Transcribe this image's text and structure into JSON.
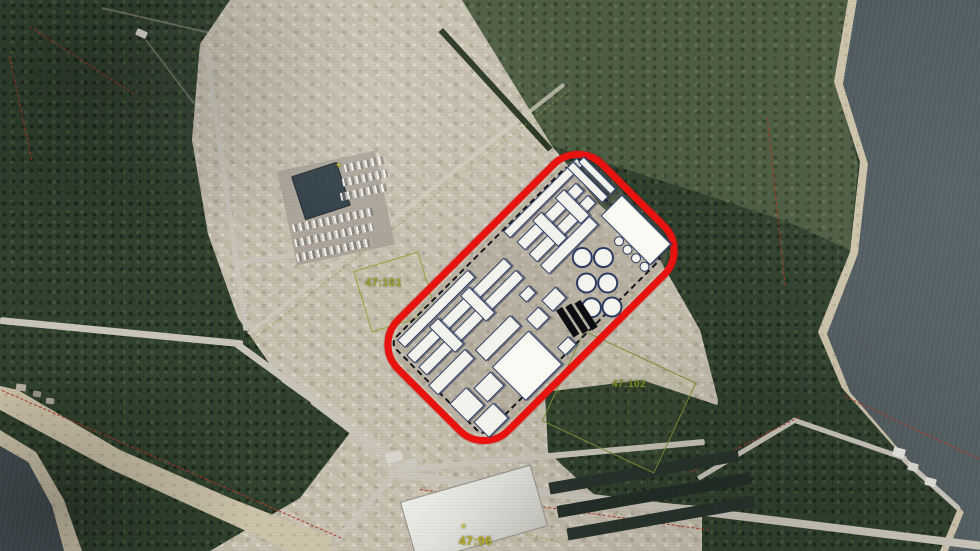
{
  "map": {
    "colors": {
      "site_outline_red": "#e8120f",
      "building_fill": "#f2f3ec",
      "building_stroke": "#2b3a63",
      "cadastral_red": "#b23726",
      "parcel_green": "#93a23a",
      "label_yellow": "#b6a81f",
      "water": "#46525a",
      "forest": "#30412e",
      "cleared_ground": "#c6bfae"
    },
    "terrain": [
      {
        "name": "forest-base",
        "tex": "forest"
      },
      {
        "name": "field-top",
        "tex": "field",
        "points": "462,0 848,0 836,80 858,165 850,250 788,222 700,193 552,146"
      },
      {
        "name": "cleared-main",
        "tex": "cleared",
        "points": "230,0 462,0 552,146 600,205 660,260 700,330 718,400 712,448 640,452 520,464 430,470 352,432 282,382 238,318 208,234 192,140 200,44"
      },
      {
        "name": "cleared-bottom",
        "tex": "cleared",
        "points": "352,430 480,462 640,430 702,452 702,551 210,551 300,498"
      },
      {
        "name": "shore-sand-strip",
        "tex": "sand",
        "points": "0,386 18,390 120,450 230,498 332,538 332,551 290,551 108,468 0,410"
      },
      {
        "name": "forest-patch-bottom",
        "tex": "forest",
        "points": "545,392 642,380 762,420 782,470 700,506 598,498 548,452"
      },
      {
        "name": "scrub-patch",
        "tex": "forest",
        "opacity": 0.55,
        "points": "788,470 868,458 932,490 858,520 788,506"
      },
      {
        "name": "beach-right",
        "tex": "sand",
        "points": "848,0 980,0 980,551 940,551 958,508 902,456 842,388 818,332 850,252 860,162 834,82"
      },
      {
        "name": "lake-right",
        "tex": "water",
        "points": "857,0 980,0 980,551 948,551 964,512 910,462 850,392 827,334 858,254 868,164 843,84"
      },
      {
        "name": "beach-bottom-left",
        "tex": "sand",
        "points": "0,430 36,452 64,500 82,551 0,551"
      },
      {
        "name": "water-bottom-left",
        "tex": "water",
        "points": "0,446 28,462 52,506 64,551 0,551"
      }
    ],
    "roads": [
      {
        "name": "road-west",
        "x": 0,
        "y": 320,
        "len": 244,
        "w": 7,
        "angle": 5.5
      },
      {
        "name": "road-mid",
        "x": 236,
        "y": 343,
        "len": 101,
        "w": 7,
        "angle": 36
      },
      {
        "name": "road-mid2",
        "x": 312,
        "y": 400,
        "len": 113,
        "w": 7,
        "angle": 37
      },
      {
        "name": "road-south-main",
        "x": 388,
        "y": 473,
        "len": 598,
        "w": 8,
        "angle": 7
      },
      {
        "name": "road-south-branch",
        "x": 396,
        "y": 470,
        "len": 310,
        "w": 6,
        "angle": -5.2
      },
      {
        "name": "road-forest-east",
        "x": 698,
        "y": 478,
        "len": 113,
        "w": 5,
        "angle": -31
      },
      {
        "name": "road-shore-east",
        "x": 792,
        "y": 419,
        "len": 121,
        "w": 5,
        "angle": 19
      },
      {
        "name": "road-shore-east2",
        "x": 903,
        "y": 458,
        "len": 76,
        "w": 5,
        "angle": 42
      },
      {
        "name": "road-site-nw",
        "x": 248,
        "y": 334,
        "len": 403,
        "w": 4,
        "angle": -38.3,
        "color": "rgba(208,203,188,0.75)"
      },
      {
        "name": "road-clearing-left",
        "x": 206,
        "y": 46,
        "len": 287,
        "w": 5,
        "angle": 82
      },
      {
        "name": "road-office-access",
        "x": 232,
        "y": 263,
        "len": 71,
        "w": 5,
        "angle": -8
      },
      {
        "name": "road-junction-south",
        "x": 396,
        "y": 472,
        "len": 92,
        "w": 6,
        "angle": 131
      },
      {
        "name": "forest-track",
        "x": 102,
        "y": 8,
        "len": 165,
        "w": 2,
        "angle": 13,
        "color": "rgba(195,190,170,0.40)"
      },
      {
        "name": "forest-track2",
        "x": 146,
        "y": 40,
        "len": 140,
        "w": 2,
        "angle": 53,
        "color": "rgba(195,190,170,0.35)"
      }
    ],
    "lines": [
      {
        "name": "tree-line",
        "x": 443,
        "y": 28,
        "len": 162,
        "angle": 47.5,
        "w": 6,
        "style": "solid",
        "color": "#273522"
      },
      {
        "name": "cadastral-line",
        "x": 2,
        "y": 390,
        "len": 370,
        "angle": 23.5,
        "w": 1.5,
        "style": "dashed",
        "color": "#b23726"
      },
      {
        "name": "cadastral-line",
        "x": 10,
        "y": 56,
        "len": 106,
        "angle": 78,
        "w": 1.5,
        "style": "dashed",
        "color": "#b23726"
      },
      {
        "name": "cadastral-line",
        "x": 420,
        "y": 489,
        "len": 292,
        "angle": 8,
        "w": 1.5,
        "style": "dashed",
        "color": "#b23726"
      },
      {
        "name": "cadastral-line",
        "x": 768,
        "y": 118,
        "len": 168,
        "angle": 84,
        "w": 1.5,
        "style": "dashed",
        "color": "#a8341f"
      },
      {
        "name": "cadastral-line",
        "x": 30,
        "y": 26,
        "len": 124,
        "angle": 33,
        "w": 1.5,
        "style": "dashed",
        "color": "#a8341f"
      },
      {
        "name": "cadastral-line",
        "x": 845,
        "y": 396,
        "len": 152,
        "angle": 25,
        "w": 1.5,
        "style": "dashed",
        "color": "#b23726"
      },
      {
        "name": "cadastral-line",
        "x": 690,
        "y": 472,
        "len": 122,
        "angle": -27,
        "w": 1.5,
        "style": "dashed",
        "color": "#b23726"
      },
      {
        "name": "parcel-line",
        "x": 252,
        "y": 340,
        "len": 405,
        "angle": -38.3,
        "w": 1.5,
        "style": "dashed",
        "color": "rgba(154,165,70,0.65)"
      },
      {
        "name": "parcel-line",
        "x": 424,
        "y": 508,
        "len": 138,
        "angle": 14,
        "w": 1.5,
        "style": "dashed",
        "color": "rgba(154,165,70,0.80)"
      }
    ],
    "structures": [
      {
        "name": "office-parking-pad",
        "x": 286,
        "y": 160,
        "w": 100,
        "h": 96,
        "angle": -12,
        "fill": "#aaa498"
      },
      {
        "name": "office-building",
        "x": 297,
        "y": 168,
        "w": 46,
        "h": 44,
        "angle": -18,
        "fill": "#2e3d46",
        "stroke": "#1c2429"
      },
      {
        "name": "parking-row",
        "x": 344,
        "y": 160,
        "w": 42,
        "h": 8,
        "angle": -12,
        "cls": "lot"
      },
      {
        "name": "parking-row",
        "x": 342,
        "y": 174,
        "w": 46,
        "h": 8,
        "angle": -12,
        "cls": "lot"
      },
      {
        "name": "parking-row",
        "x": 340,
        "y": 188,
        "w": 48,
        "h": 8,
        "angle": -12,
        "cls": "lot"
      },
      {
        "name": "parking-row",
        "x": 292,
        "y": 216,
        "w": 82,
        "h": 8,
        "angle": -12,
        "cls": "lot"
      },
      {
        "name": "parking-row",
        "x": 294,
        "y": 231,
        "w": 80,
        "h": 8,
        "angle": -12,
        "cls": "lot"
      },
      {
        "name": "parking-row",
        "x": 296,
        "y": 246,
        "w": 76,
        "h": 8,
        "angle": -12,
        "cls": "lot"
      },
      {
        "name": "warehouse-building",
        "x": 406,
        "y": 482,
        "w": 134,
        "h": 62,
        "angle": -16,
        "cls": "warehouse",
        "stroke": "#90908a"
      },
      {
        "name": "tree-row",
        "x": 548,
        "y": 466,
        "w": 192,
        "h": 12,
        "angle": -10,
        "fill": "#27332c"
      },
      {
        "name": "tree-row",
        "x": 556,
        "y": 489,
        "w": 196,
        "h": 12,
        "angle": -10,
        "fill": "#222e27"
      },
      {
        "name": "tree-row",
        "x": 566,
        "y": 512,
        "w": 190,
        "h": 12,
        "angle": -10,
        "fill": "#27332c"
      },
      {
        "name": "small-building",
        "x": 386,
        "y": 452,
        "w": 16,
        "h": 10,
        "angle": -14,
        "fill": "#d8d5cc"
      },
      {
        "name": "small-building",
        "x": 405,
        "y": 459,
        "w": 12,
        "h": 8,
        "angle": -14,
        "fill": "#ccc9bf"
      },
      {
        "name": "small-building",
        "x": 136,
        "y": 30,
        "w": 11,
        "h": 7,
        "angle": 24,
        "fill": "#dad7d0"
      },
      {
        "name": "house",
        "x": 16,
        "y": 384,
        "w": 10,
        "h": 7,
        "angle": 8,
        "fill": "#b9b3a6"
      },
      {
        "name": "house",
        "x": 33,
        "y": 391,
        "w": 8,
        "h": 6,
        "angle": 8,
        "fill": "#99948a"
      },
      {
        "name": "house",
        "x": 46,
        "y": 398,
        "w": 8,
        "h": 6,
        "angle": 8,
        "fill": "#aaa59b"
      },
      {
        "name": "shore-house",
        "x": 893,
        "y": 448,
        "w": 12,
        "h": 9,
        "angle": 15,
        "fill": "#e9e7e0"
      },
      {
        "name": "shore-house",
        "x": 908,
        "y": 463,
        "w": 10,
        "h": 8,
        "angle": 15,
        "fill": "#dcdad2"
      },
      {
        "name": "shore-house",
        "x": 925,
        "y": 478,
        "w": 11,
        "h": 8,
        "angle": 15,
        "fill": "#e2e0d8"
      },
      {
        "name": "parcel-47-101-boundary",
        "x": 361,
        "y": 260,
        "w": 66,
        "h": 62,
        "angle": -17,
        "cls": "parcel",
        "stroke": "#93a23a"
      },
      {
        "name": "parcel-47-102-boundary",
        "x": 557,
        "y": 352,
        "w": 122,
        "h": 98,
        "angle": 25,
        "cls": "parcel",
        "stroke": "#7f8f35"
      }
    ],
    "site_plan": {
      "frame": {
        "left": 383,
        "top": 216,
        "w": 282,
        "h": 149,
        "angle": -45,
        "stroke": "#e8120f",
        "stroke_w": 7,
        "radius": 38
      },
      "dashed_boundary": {
        "x": 8,
        "y": 6,
        "w": 252,
        "h": 130
      },
      "buildings": [
        {
          "x": 16,
          "y": 10,
          "w": 100,
          "h": 11
        },
        {
          "x": 12,
          "y": 27,
          "w": 138,
          "h": 12
        },
        {
          "x": 12,
          "y": 44,
          "w": 138,
          "h": 12
        },
        {
          "x": 48,
          "y": 23,
          "w": 13,
          "h": 37
        },
        {
          "x": 92,
          "y": 23,
          "w": 13,
          "h": 37
        },
        {
          "x": 6,
          "y": 64,
          "w": 52,
          "h": 14
        },
        {
          "x": 64,
          "y": 72,
          "w": 50,
          "h": 16
        },
        {
          "x": 8,
          "y": 92,
          "w": 24,
          "h": 26
        },
        {
          "x": 12,
          "y": 122,
          "w": 28,
          "h": 22
        },
        {
          "x": 36,
          "y": 98,
          "w": 24,
          "h": 20
        },
        {
          "x": 64,
          "y": 96,
          "w": 52,
          "h": 48,
          "bright": true
        },
        {
          "x": 122,
          "y": 86,
          "w": 18,
          "h": 16
        },
        {
          "x": 124,
          "y": 128,
          "w": 16,
          "h": 12
        },
        {
          "x": 168,
          "y": 8,
          "w": 104,
          "h": 10
        },
        {
          "x": 170,
          "y": 25,
          "w": 84,
          "h": 12
        },
        {
          "x": 170,
          "y": 42,
          "w": 84,
          "h": 12
        },
        {
          "x": 196,
          "y": 21,
          "w": 13,
          "h": 37
        },
        {
          "x": 228,
          "y": 21,
          "w": 13,
          "h": 37
        },
        {
          "x": 258,
          "y": 8,
          "w": 9,
          "h": 50
        },
        {
          "x": 270,
          "y": 12,
          "w": 8,
          "h": 46
        },
        {
          "x": 170,
          "y": 58,
          "w": 70,
          "h": 13
        },
        {
          "x": 134,
          "y": 64,
          "w": 14,
          "h": 11
        },
        {
          "x": 146,
          "y": 84,
          "w": 20,
          "h": 16
        },
        {
          "x": 248,
          "y": 66,
          "w": 30,
          "h": 70,
          "bright": true
        }
      ],
      "tanks_large": {
        "d": 21,
        "centers": [
          {
            "cx": 205,
            "cy": 82
          },
          {
            "cx": 190,
            "cy": 103
          },
          {
            "cx": 176,
            "cy": 124
          },
          {
            "cx": 220,
            "cy": 97
          },
          {
            "cx": 205,
            "cy": 118
          },
          {
            "cx": 191,
            "cy": 138
          }
        ]
      },
      "tanks_small": {
        "d": 10,
        "centers": [
          {
            "cx": 243,
            "cy": 97
          },
          {
            "cx": 243,
            "cy": 109
          },
          {
            "cx": 243,
            "cy": 121
          },
          {
            "cx": 243,
            "cy": 133
          }
        ]
      },
      "dark_bars": [
        {
          "x": 146,
          "y": 102,
          "w": 7,
          "h": 32
        },
        {
          "x": 155,
          "y": 106,
          "w": 7,
          "h": 32
        },
        {
          "x": 164,
          "y": 110,
          "w": 7,
          "h": 32
        }
      ]
    },
    "labels": [
      {
        "text": "47:101",
        "x": 365,
        "y": 277,
        "size": 11,
        "color": "#9aa32d"
      },
      {
        "text": "47:102",
        "x": 612,
        "y": 379,
        "size": 10,
        "color": "#7e8c2a"
      },
      {
        "text": "47:96",
        "x": 459,
        "y": 534,
        "size": 12,
        "color": "#b6a81f"
      },
      {
        "text": "+",
        "x": 336,
        "y": 160,
        "size": 9,
        "color": "#c9c23a"
      },
      {
        "text": "+",
        "x": 461,
        "y": 521,
        "size": 9,
        "color": "#c9c23a"
      }
    ]
  }
}
